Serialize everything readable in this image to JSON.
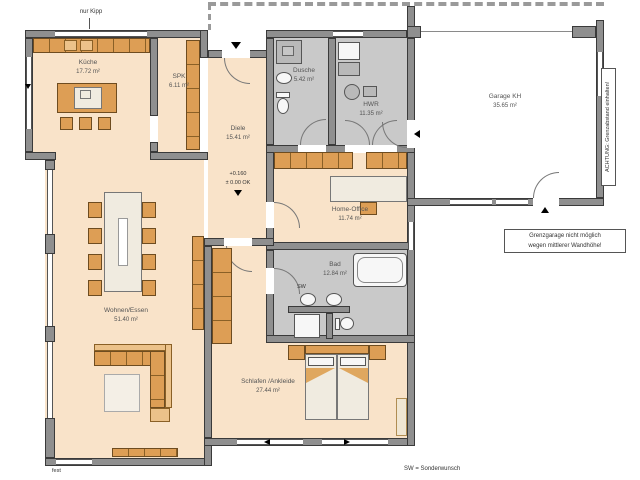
{
  "rooms": [
    {
      "id": "kueche",
      "name": "Küche",
      "area": "17.72 m²"
    },
    {
      "id": "spk",
      "name": "SPK",
      "area": "6.11 m²"
    },
    {
      "id": "diele",
      "name": "Diele",
      "area": "15.41 m²"
    },
    {
      "id": "dusche",
      "name": "Dusche",
      "area": "5.42 m²"
    },
    {
      "id": "hwr",
      "name": "HWR",
      "area": "11.35 m²"
    },
    {
      "id": "garage",
      "name": "Garage KH",
      "area": "35.65 m²"
    },
    {
      "id": "homeoffice",
      "name": "Home-Office",
      "area": "11.74 m²"
    },
    {
      "id": "bad",
      "name": "Bad",
      "area": "12.84 m²"
    },
    {
      "id": "wohnen",
      "name": "Wohnen/Essen",
      "area": "51.40 m²"
    },
    {
      "id": "schlafen",
      "name": "Schlafen /Ankleide",
      "area": "27.44 m²"
    }
  ],
  "annotations": {
    "nur_kipp": "nur Kipp",
    "fest": "fest",
    "sw_label": "SW",
    "sw_legend": "SW = Sonderwunsch",
    "achtung": "ACHTUNG: Grenzabstand einhalten!",
    "note_line1": "Grenzgarage nicht möglich",
    "note_line2": "wegen mittlerer Wandhöhe!",
    "level_value": "+0.160",
    "level_ok": "± 0.00 OK"
  },
  "colors": {
    "wall": "#8f8f8f",
    "floor_living": "#f9e3c9",
    "floor_wet": "#c9c9c9",
    "floor_garage": "#ffffff",
    "furniture": "#dd9e55",
    "furniture_light": "#ecc28a",
    "fixture_cream": "#f0ebe0"
  }
}
